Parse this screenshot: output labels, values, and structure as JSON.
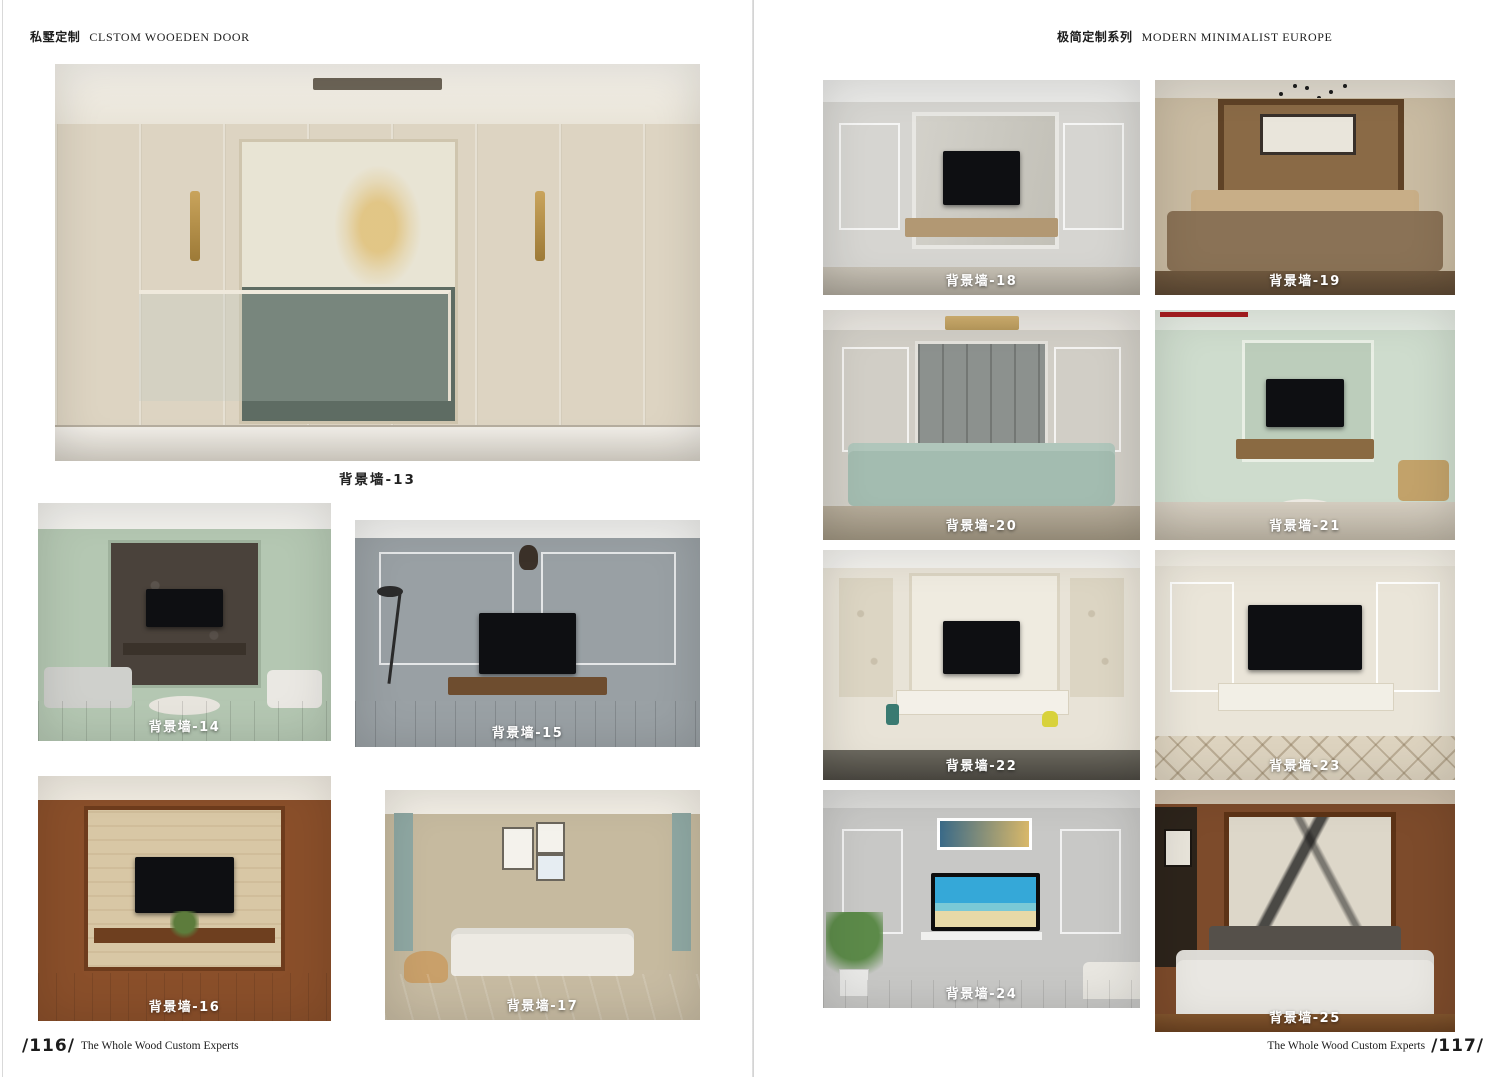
{
  "left_page": {
    "header": {
      "title_cn": "私墅定制",
      "title_en": "CLSTOM WOOEDEN DOOR"
    },
    "footer": {
      "page_number": "/116/",
      "tagline": "The Whole Wood Custom Experts"
    },
    "photos": [
      {
        "label": "背景墙-13"
      },
      {
        "label": "背景墙-14"
      },
      {
        "label": "背景墙-15"
      },
      {
        "label": "背景墙-16"
      },
      {
        "label": "背景墙-17"
      }
    ]
  },
  "right_page": {
    "header": {
      "title_cn": "极简定制系列",
      "title_en": "MODERN MINIMALIST EUROPE"
    },
    "footer": {
      "page_number": "/117/",
      "tagline": "The Whole Wood Custom Experts"
    },
    "accent_color": "#9e1b1e",
    "photos": [
      {
        "label": "背景墙-18"
      },
      {
        "label": "背景墙-19"
      },
      {
        "label": "背景墙-20"
      },
      {
        "label": "背景墙-21"
      },
      {
        "label": "背景墙-22"
      },
      {
        "label": "背景墙-23"
      },
      {
        "label": "背景墙-24"
      },
      {
        "label": "背景墙-25"
      }
    ]
  }
}
